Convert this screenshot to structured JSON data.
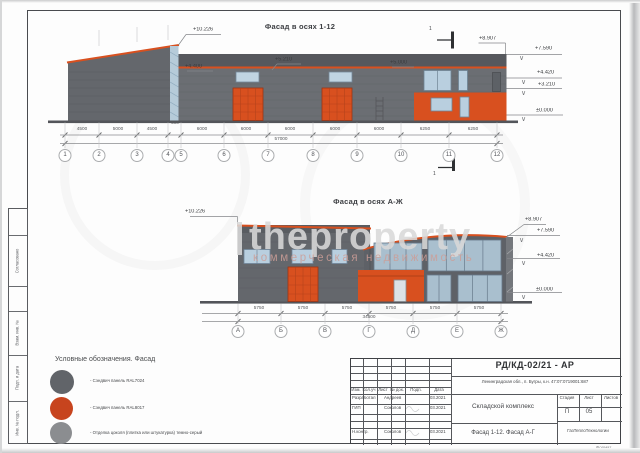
{
  "watermark": {
    "main": "theproperty",
    "sub": "коммерческая недвижимость"
  },
  "facade1": {
    "title": "Фасад в осях 1-12",
    "marks": {
      "peak": "+10.226",
      "wall": "+4.400",
      "mid1": "+5.210",
      "mid2": "+5.000",
      "parapet": "+8.907",
      "r1": "+7.590",
      "r2": "+4.420",
      "r3": "+3.210",
      "r4": "±0.000"
    },
    "dims": [
      "4500",
      "5000",
      "4500",
      "500",
      "6000",
      "6000",
      "6000",
      "6000",
      "6000",
      "6250",
      "6250"
    ],
    "total": "57000",
    "axes": [
      "1",
      "2",
      "3",
      "4",
      "5",
      "6",
      "7",
      "8",
      "9",
      "10",
      "11",
      "12"
    ],
    "section_label": "1"
  },
  "facade2": {
    "title": "Фасад в осях А-Ж",
    "marks": {
      "peak": "+10.226",
      "parapet": "+8.907",
      "r1": "+7.590",
      "r2": "+4.420",
      "r3": "±0.000"
    },
    "dims": [
      "5750",
      "5750",
      "5750",
      "5750",
      "5750",
      "5750"
    ],
    "total": "34500",
    "axes": [
      "А",
      "Б",
      "В",
      "Г",
      "Д",
      "Е",
      "Ж"
    ]
  },
  "legend": {
    "title": "Условные обозначения. Фасад",
    "items": [
      {
        "label": "- Сэндвич панель  RAL7024",
        "color": "#616469",
        "style": "background:#616469"
      },
      {
        "label": "- Сэндвич панель  RAL8017",
        "color": "#c7441e",
        "style": "background:#c7441e"
      },
      {
        "label": "- Отделка цоколя (плитка или штукатурка) темно-серый",
        "color": "#8b8d90",
        "style": "background:#8b8d90"
      }
    ]
  },
  "titleblock": {
    "code": "РД/КД-02/21 - АР",
    "address": "Ленинградская обл., п. Бугры, к.н. 47:07:0719001:687",
    "object": "Складской комплекс",
    "drawing": "Фасад 1-12. Фасад А-Г",
    "company": "ГазТеплоТехнологии",
    "stage_label": "Стадия",
    "sheet_label": "Лист",
    "sheets_label": "Листов",
    "stage": "П",
    "sheet_no": "05",
    "header": [
      "Изм.",
      "Кол.уч",
      "Лист",
      "№ док.",
      "Подп.",
      "Дата"
    ],
    "rows": [
      {
        "role": "Разработал",
        "name": "Андреев",
        "date": "03.2021"
      },
      {
        "role": "ГИП",
        "name": "Соколов",
        "date": "03.2021"
      },
      {
        "role": "Н.контр.",
        "name": "Соколов",
        "date": "03.2021"
      }
    ],
    "format_label": "Формат"
  },
  "side_strip": {
    "labels": [
      "Согласовано",
      "Взам. инв. №",
      "Подп. и дата",
      "Инв. № подл."
    ]
  },
  "colors": {
    "panel_gray": "#6b6e73",
    "panel_dark": "#56585d",
    "accent_orange": "#d8501f",
    "window_blue": "#b9cfdf",
    "ground": "#53555a"
  }
}
